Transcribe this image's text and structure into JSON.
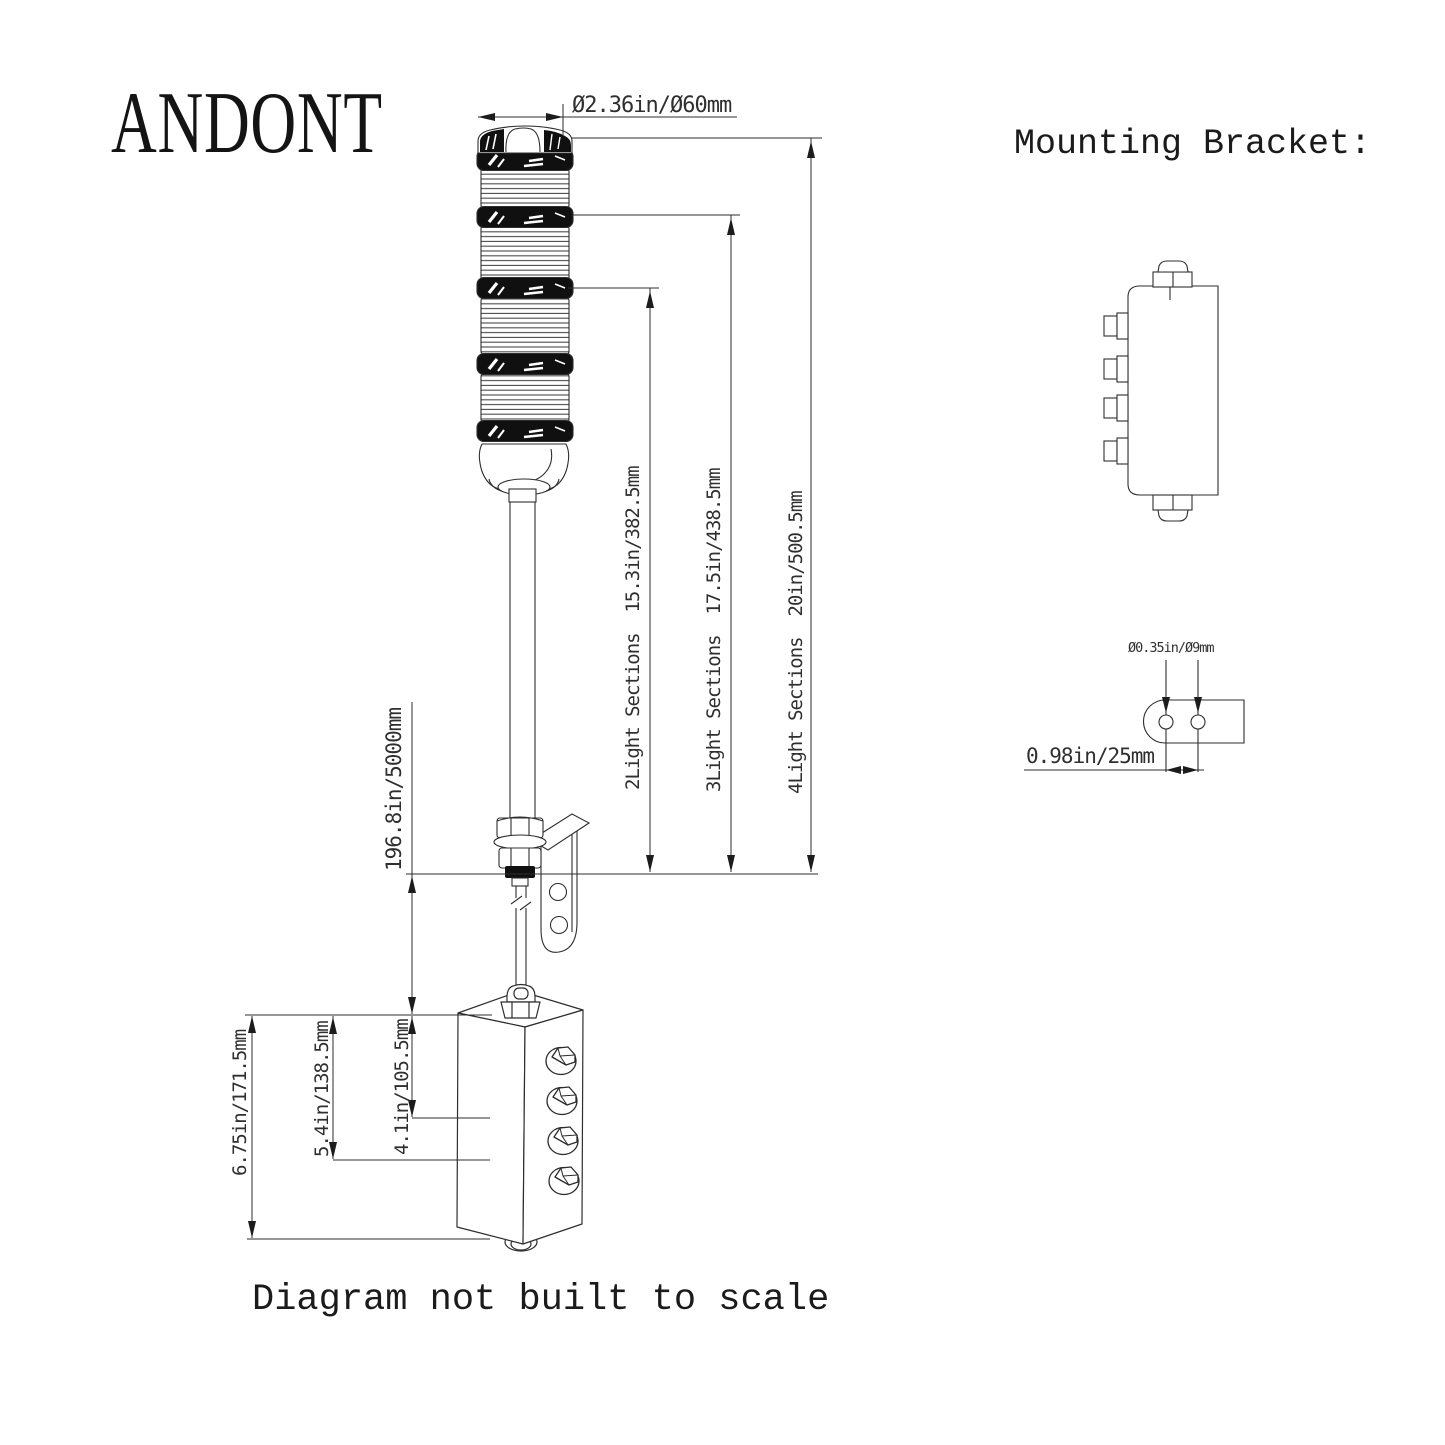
{
  "brand": "ANDONT",
  "footer": "Diagram not built to scale",
  "mounting": {
    "title": "Mounting Bracket:",
    "hole_diameter": "Ø0.35in/Ø9mm",
    "hole_spacing": "0.98in/25mm"
  },
  "dimensions": {
    "cap_diameter": "Ø2.36in/Ø60mm",
    "two_light": "2Light Sections  15.3in/382.5mm",
    "three_light": "3Light Sections  17.5in/438.5mm",
    "four_light": "4Light Sections  20in/500.5mm",
    "cable_length": "196.8in/5000mm",
    "box_total_height": "6.75in/171.5mm",
    "box_mid_height": "5.4in/138.5mm",
    "box_small_height": "4.1in/105.5mm"
  },
  "colors": {
    "background": "#ffffff",
    "line": "#2e2e2e",
    "dark_fill": "#101010",
    "text": "#2a2a2a"
  }
}
